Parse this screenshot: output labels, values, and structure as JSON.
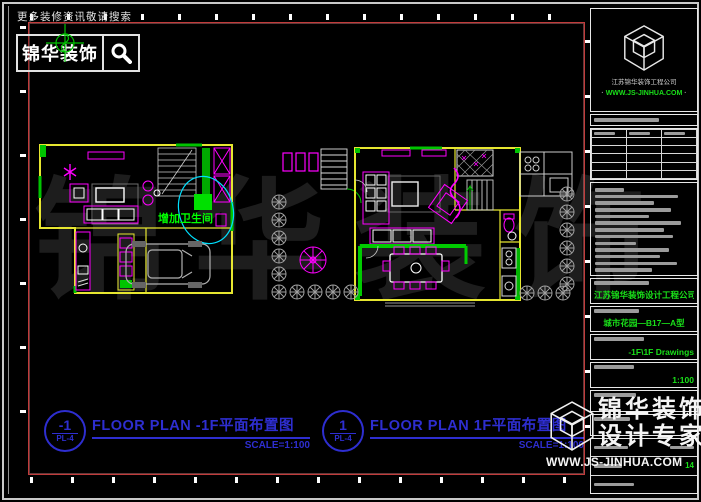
{
  "banner": {
    "hint": "更多装修资讯敬请搜索",
    "brand": "锦华装饰"
  },
  "plan_annotation": {
    "add_bathroom": "增加卫生间"
  },
  "plan_labels": {
    "left": {
      "number": "-1",
      "sheet": "PL-4",
      "title": "FLOOR PLAN -1F平面布置图",
      "scale": "SCALE=1:100"
    },
    "right": {
      "number": "1",
      "sheet": "PL-4",
      "title": "FLOOR PLAN 1F平面布置图",
      "scale": "SCALE=1:100"
    }
  },
  "titleblock": {
    "company": "江苏锦华装饰工程公司",
    "website": "WWW.JS-JINHUA.COM",
    "project": "江苏锦华装饰设计工程公司",
    "site": "城市花园—B17—A型",
    "drawing_name": "-1F\\1F Drawings",
    "scale": "1:100",
    "sheet_no": "14"
  },
  "watermarks": {
    "big_text": "锦华装饰",
    "corner_brand": "锦华装饰",
    "corner_tagline": "设计专家",
    "corner_site": "WWW.JS-JINHUA.COM"
  }
}
